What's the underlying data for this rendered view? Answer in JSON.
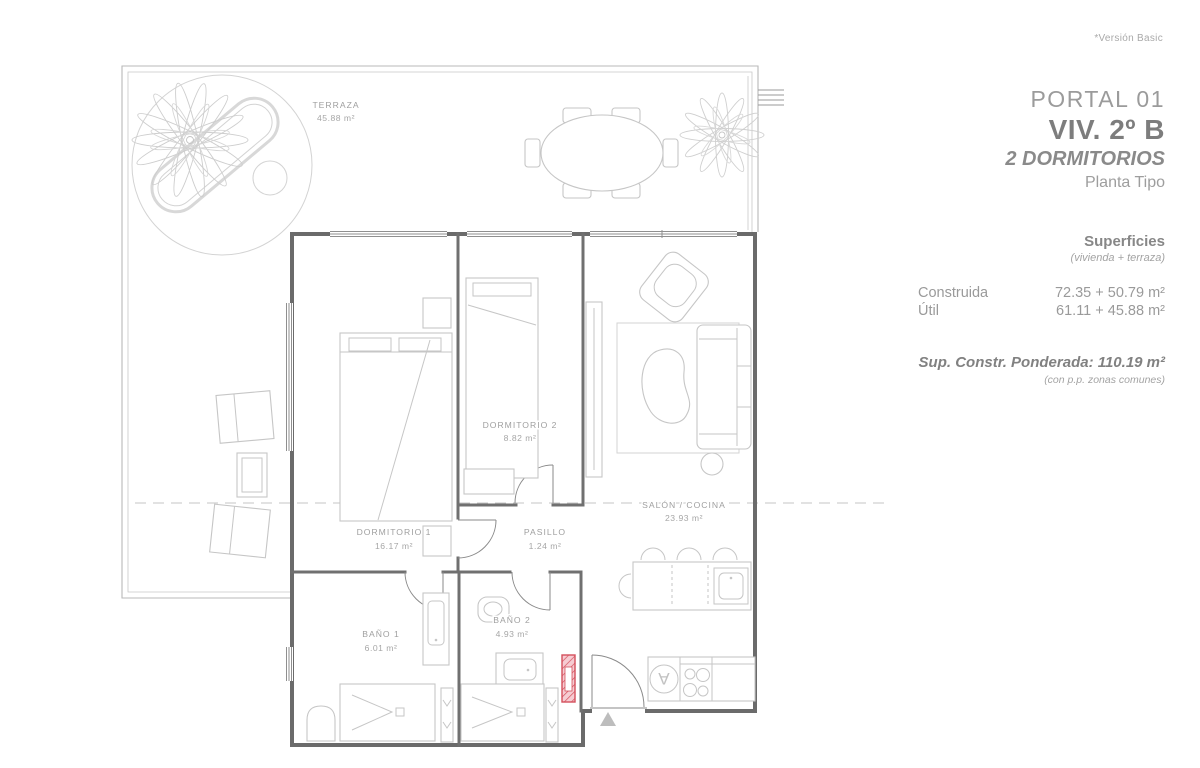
{
  "meta": {
    "version_note": "*Versión Basic"
  },
  "header": {
    "portal": "PORTAL 01",
    "unit": "VIV. 2º B",
    "bedrooms": "2 DORMITORIOS",
    "plan_type": "Planta Tipo"
  },
  "surfaces": {
    "title": "Superficies",
    "subtitle": "(vivienda + terraza)",
    "rows": [
      {
        "label": "Construida",
        "value": "72.35 + 50.79 m²"
      },
      {
        "label": "Útil",
        "value": "61.11 + 45.88 m²"
      }
    ],
    "weighted": "Sup. Constr. Ponderada: 110.19 m²",
    "weighted_note": "(con p.p. zonas comunes)"
  },
  "rooms": [
    {
      "name": "TERRAZA",
      "area": "45.88 m²"
    },
    {
      "name": "DORMITORIO 2",
      "area": "8.82 m²"
    },
    {
      "name": "DORMITORIO 1",
      "area": "16.17 m²"
    },
    {
      "name": "PASILLO",
      "area": "1.24 m²"
    },
    {
      "name": "SALÓN / COCINA",
      "area": "23.93 m²"
    },
    {
      "name": "BAÑO 1",
      "area": "6.01 m²"
    },
    {
      "name": "BAÑO 2",
      "area": "4.93 m²"
    }
  ],
  "appliances": {
    "washer_label": "A"
  },
  "colors": {
    "wall": "#6b6b6b",
    "furniture": "#c6c6c6",
    "label_text": "#9f9f9f",
    "shaft_red": "#d4505c",
    "shaft_pink": "#f6ccd2"
  }
}
